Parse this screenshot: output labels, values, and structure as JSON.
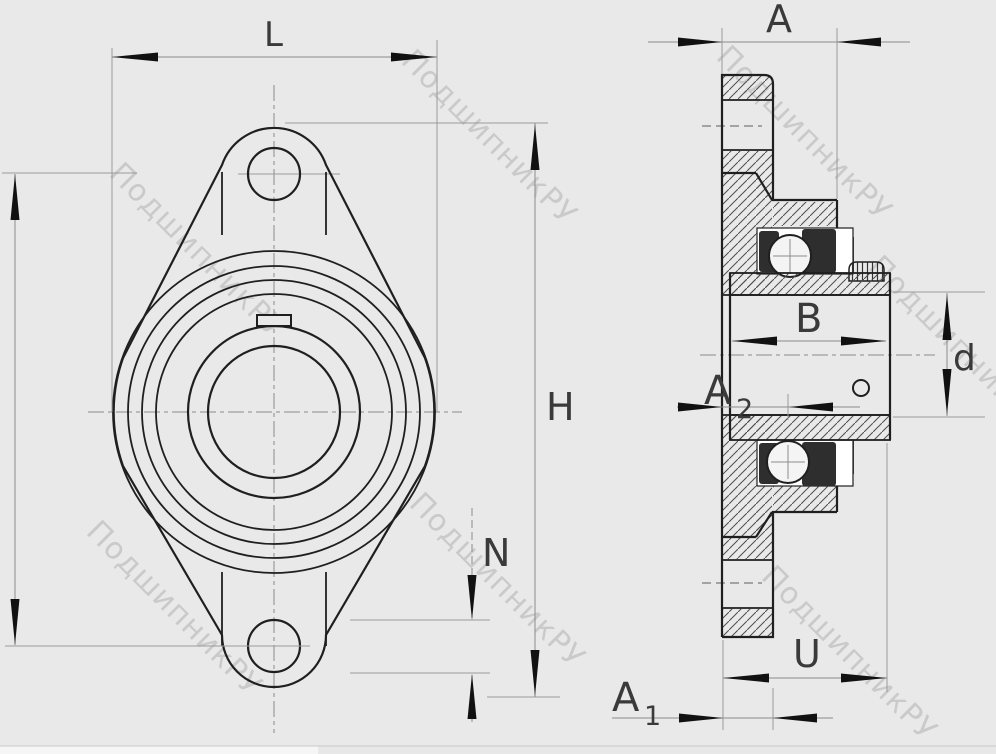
{
  "watermark": {
    "text": "ПодшипникРУ"
  },
  "front_view": {
    "dim_L": "L",
    "dim_H": "H",
    "dim_N": "N"
  },
  "side_view": {
    "dim_A": "A",
    "dim_B": "B",
    "dim_d": "d",
    "dim_U": "U",
    "dim_A1_main": "A",
    "dim_A1_sub": "1",
    "dim_A2_main": "A",
    "dim_A2_sub": "2"
  },
  "colors": {
    "background": "#e9e9e9",
    "line": "#1f1f1f",
    "dimension": "#8c8c8c",
    "watermark": "#c7c7c7"
  }
}
